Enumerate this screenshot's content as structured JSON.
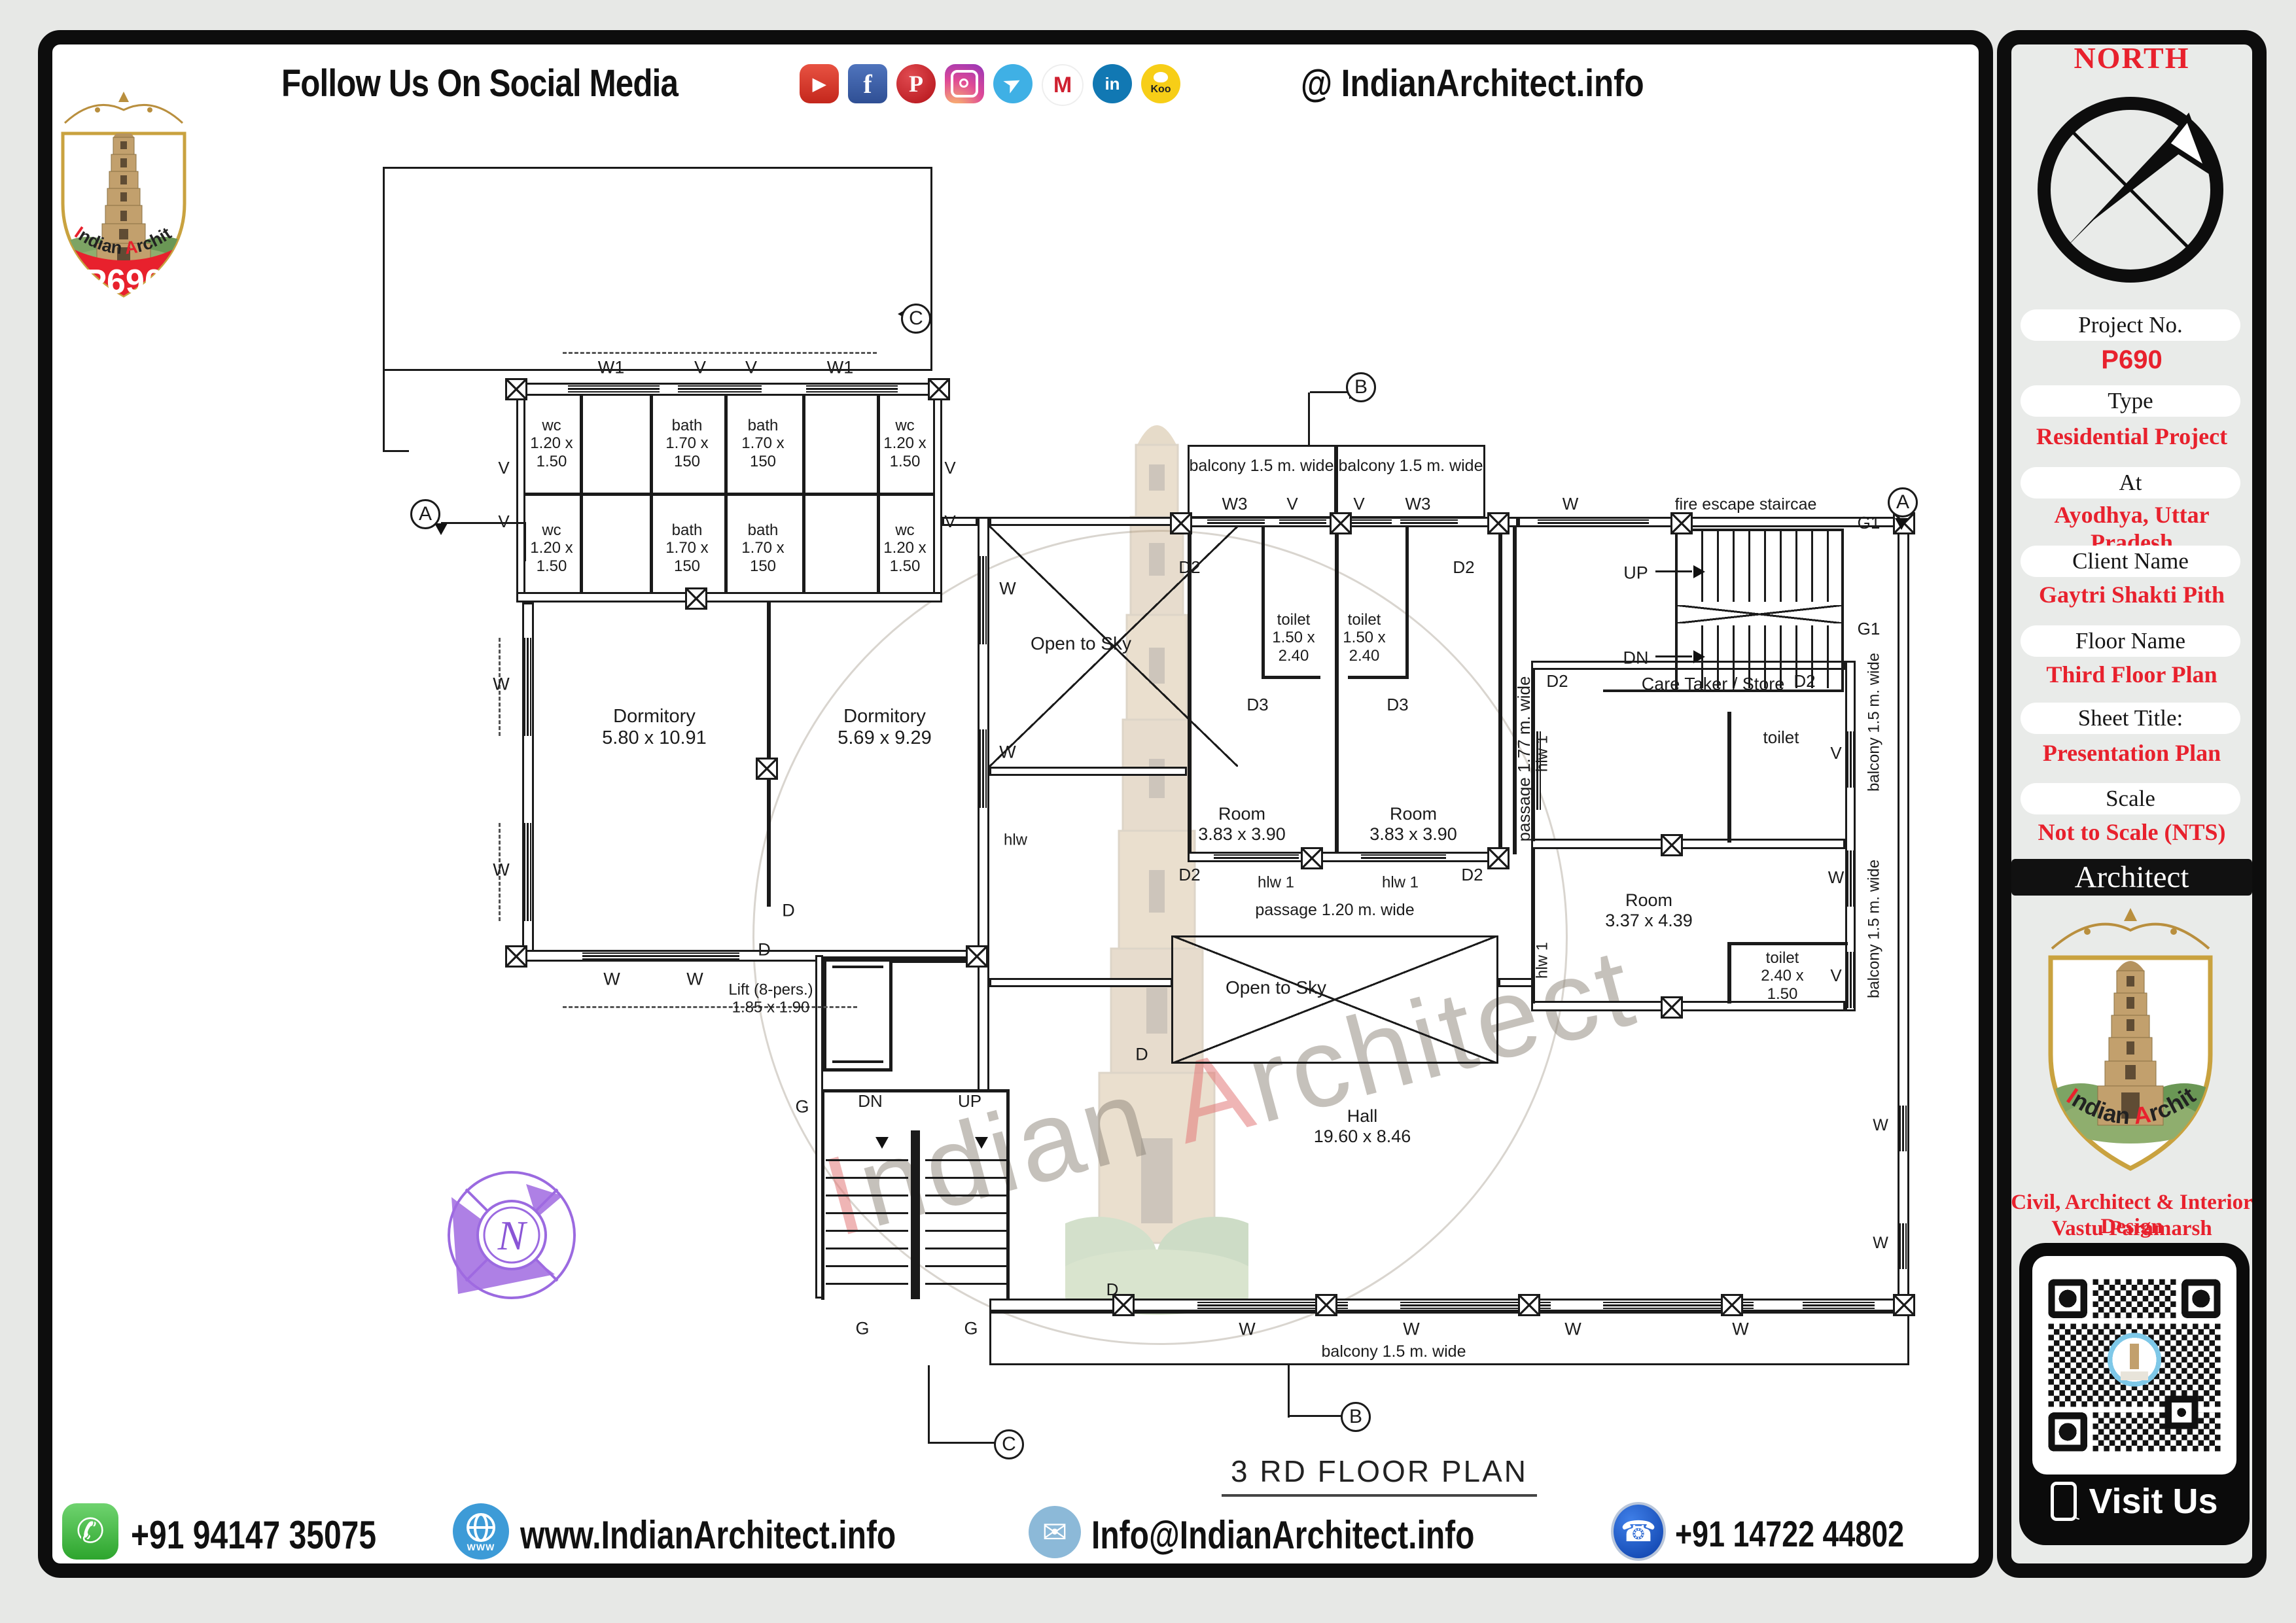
{
  "header": {
    "title": "Follow Us On Social Media",
    "handle": "@ IndianArchitect.info",
    "icons": [
      {
        "name": "youtube-icon",
        "glyph": "▶"
      },
      {
        "name": "facebook-icon",
        "glyph": "f"
      },
      {
        "name": "pinterest-icon",
        "glyph": "P"
      },
      {
        "name": "instagram-icon",
        "glyph": ""
      },
      {
        "name": "telegram-icon",
        "glyph": "➤"
      },
      {
        "name": "moj-icon",
        "glyph": "M"
      },
      {
        "name": "linkedin-icon",
        "glyph": "in"
      },
      {
        "name": "koo-icon",
        "glyph": "Koo"
      }
    ]
  },
  "brand": {
    "p1": "I",
    "p2": "ndian ",
    "p3": "A",
    "p4": "rchitect",
    "project": "P690"
  },
  "sidebar": {
    "north": "NORTH",
    "compass_n": "N",
    "fields": [
      {
        "label": "Project No.",
        "value": "P690"
      },
      {
        "label": "Type",
        "value": "Residential Project"
      },
      {
        "label": "At",
        "value": "Ayodhya, Uttar Pradesh"
      },
      {
        "label": "Client Name",
        "value": "Gaytri Shakti Pith"
      },
      {
        "label": "Floor Name",
        "value": "Third Floor Plan"
      },
      {
        "label": "Sheet Title:",
        "value": "Presentation Plan"
      },
      {
        "label": "Scale",
        "value": "Not to Scale (NTS)"
      }
    ],
    "architect_bar": "Architect",
    "tagline1": "Civil, Architect & Interior Design",
    "tagline2": "Vastu Paramarsh",
    "visit": "Visit Us"
  },
  "footer": {
    "items": [
      {
        "icon": "whatsapp-icon",
        "text": "+91 94147 35075"
      },
      {
        "icon": "globe-icon",
        "text": "www.IndianArchitect.info"
      },
      {
        "icon": "mail-icon",
        "text": "Info@IndianArchitect.info"
      },
      {
        "icon": "phone-icon",
        "text": "+91 14722 44802"
      }
    ]
  },
  "plan": {
    "title": "3 RD  FLOOR PLAN",
    "walls": [
      [
        800,
        585,
        640,
        20
      ],
      [
        789,
        585,
        14,
        336
      ],
      [
        1426,
        585,
        14,
        336
      ],
      [
        789,
        905,
        651,
        16
      ],
      [
        798,
        921,
        18,
        549
      ],
      [
        798,
        1452,
        714,
        18
      ],
      [
        1494,
        790,
        18,
        680
      ],
      [
        1512,
        790,
        303,
        14
      ],
      [
        1815,
        790,
        505,
        16
      ],
      [
        2320,
        790,
        598,
        16
      ],
      [
        2900,
        790,
        18,
        1215
      ],
      [
        1440,
        790,
        54,
        14
      ],
      [
        2340,
        1010,
        480,
        14
      ],
      [
        2340,
        1282,
        480,
        16
      ],
      [
        2340,
        1530,
        480,
        16
      ],
      [
        2820,
        1010,
        16,
        536
      ],
      [
        1815,
        1302,
        483,
        16
      ],
      [
        1512,
        1985,
        1406,
        20
      ],
      [
        1246,
        1460,
        12,
        525
      ],
      [
        1512,
        1172,
        302,
        14
      ],
      [
        1512,
        1495,
        280,
        14
      ],
      [
        2290,
        1495,
        54,
        14
      ],
      [
        1494,
        1470,
        18,
        200
      ]
    ],
    "thin": [
      [
        886,
        605,
        5,
        300
      ],
      [
        993,
        605,
        5,
        300
      ],
      [
        1107,
        605,
        5,
        300
      ],
      [
        1226,
        605,
        5,
        300
      ],
      [
        1340,
        605,
        5,
        300
      ],
      [
        803,
        753,
        623,
        5
      ],
      [
        1172,
        921,
        6,
        465
      ],
      [
        1815,
        806,
        6,
        496
      ],
      [
        2040,
        806,
        6,
        496
      ],
      [
        2290,
        806,
        6,
        496
      ],
      [
        2312,
        806,
        6,
        500
      ],
      [
        1928,
        806,
        5,
        232
      ],
      [
        2148,
        806,
        5,
        232
      ],
      [
        1928,
        1033,
        90,
        5
      ],
      [
        2060,
        1033,
        90,
        5
      ],
      [
        2640,
        1088,
        6,
        200
      ],
      [
        2340,
        1024,
        6,
        262
      ],
      [
        2340,
        1298,
        6,
        236
      ],
      [
        2640,
        1440,
        6,
        94
      ],
      [
        2640,
        1440,
        184,
        5
      ],
      [
        1255,
        1665,
        288,
        5
      ],
      [
        1255,
        1665,
        5,
        322
      ],
      [
        1538,
        1665,
        5,
        322
      ],
      [
        1392,
        1728,
        14,
        258
      ],
      [
        2560,
        808,
        258,
        4
      ],
      [
        2560,
        808,
        4,
        250
      ],
      [
        2814,
        808,
        4,
        250
      ],
      [
        2450,
        1054,
        368,
        4
      ],
      [
        1258,
        1462,
        106,
        5
      ],
      [
        1258,
        1462,
        5,
        176
      ],
      [
        1359,
        1462,
        5,
        176
      ],
      [
        1258,
        1633,
        106,
        5
      ],
      [
        1272,
        1476,
        78,
        4
      ],
      [
        1272,
        1621,
        78,
        4
      ],
      [
        1364,
        1462,
        130,
        10
      ]
    ],
    "outlines": [
      [
        1815,
        680,
        227,
        112
      ],
      [
        2042,
        680,
        228,
        112
      ],
      [
        1790,
        1430,
        500,
        196
      ],
      [
        1512,
        2005,
        1406,
        82
      ],
      [
        585,
        255,
        840,
        312
      ]
    ],
    "windows_h": [
      [
        868,
        589,
        140
      ],
      [
        1036,
        589,
        128
      ],
      [
        1232,
        589,
        140
      ],
      [
        890,
        1456,
        240
      ],
      [
        1845,
        794,
        88
      ],
      [
        1955,
        794,
        72
      ],
      [
        2055,
        794,
        72
      ],
      [
        2140,
        794,
        88
      ],
      [
        2350,
        794,
        170
      ],
      [
        1855,
        1306,
        130
      ],
      [
        2080,
        1306,
        130
      ],
      [
        1830,
        1990,
        230
      ],
      [
        2140,
        1990,
        230
      ],
      [
        2450,
        1990,
        230
      ],
      [
        2755,
        1990,
        110
      ]
    ],
    "windows_v": [
      [
        801,
        975,
        150
      ],
      [
        801,
        1258,
        150
      ],
      [
        1497,
        850,
        135
      ],
      [
        1497,
        1115,
        120
      ],
      [
        2823,
        1118,
        86
      ],
      [
        2823,
        1300,
        86
      ],
      [
        2823,
        1455,
        86
      ],
      [
        2903,
        1690,
        70
      ],
      [
        2903,
        1870,
        70
      ],
      [
        2344,
        1118,
        120
      ]
    ],
    "posts": [
      [
        772,
        578
      ],
      [
        1418,
        578
      ],
      [
        1047,
        898
      ],
      [
        772,
        1445
      ],
      [
        1476,
        1445
      ],
      [
        1155,
        1158
      ],
      [
        1788,
        783
      ],
      [
        2032,
        783
      ],
      [
        2273,
        783
      ],
      [
        2553,
        783
      ],
      [
        2893,
        783
      ],
      [
        1988,
        1295
      ],
      [
        2273,
        1295
      ],
      [
        2538,
        1275
      ],
      [
        2538,
        1523
      ],
      [
        1700,
        1978
      ],
      [
        2010,
        1978
      ],
      [
        2320,
        1978
      ],
      [
        2630,
        1978
      ],
      [
        2893,
        1978
      ]
    ],
    "crosses": [
      [
        1512,
        804,
        380,
        368
      ],
      [
        1790,
        1430,
        500,
        196
      ],
      [
        2560,
        925,
        258,
        28
      ]
    ],
    "dashes_h": [
      [
        860,
        538,
        480
      ],
      [
        860,
        1538,
        450
      ]
    ],
    "dashes_v": [
      [
        762,
        975,
        150
      ],
      [
        762,
        1258,
        150
      ]
    ],
    "lines": [
      [
        585,
        567,
        3,
        123
      ],
      [
        585,
        688,
        40,
        3
      ],
      [
        1999,
        600,
        3,
        82
      ],
      [
        2002,
        598,
        58,
        3
      ],
      [
        674,
        798,
        130,
        3
      ],
      [
        801,
        798,
        3,
        60
      ],
      [
        1968,
        2087,
        3,
        80
      ],
      [
        1968,
        2163,
        86,
        3
      ],
      [
        1418,
        2087,
        3,
        120
      ],
      [
        1418,
        2204,
        106,
        3
      ],
      [
        2530,
        872,
        56,
        3
      ],
      [
        2530,
        1002,
        56,
        3
      ]
    ],
    "stairs": [
      [
        1262,
        1772,
        126,
        212,
        "h"
      ],
      [
        1414,
        1772,
        126,
        212,
        "h"
      ],
      [
        2600,
        812,
        214,
        108,
        "v"
      ],
      [
        2600,
        956,
        214,
        96,
        "v"
      ]
    ],
    "tris": [
      [
        2062,
        590,
        "r"
      ],
      [
        2056,
        2156,
        "r"
      ],
      [
        1526,
        2197,
        "r"
      ],
      [
        1372,
        470,
        "l"
      ],
      [
        2588,
        864,
        "r"
      ],
      [
        2588,
        994,
        "r"
      ],
      [
        1338,
        1738,
        "d"
      ],
      [
        1490,
        1738,
        "d"
      ],
      [
        2896,
        792,
        "d"
      ],
      [
        664,
        800,
        "d"
      ]
    ],
    "labels": [
      [
        "W1",
        934,
        562,
        27
      ],
      [
        "V",
        1070,
        562,
        27
      ],
      [
        "V",
        1148,
        562,
        27
      ],
      [
        "W1",
        1284,
        562,
        27
      ],
      [
        "wc\n1.20 x\n1.50",
        843,
        678,
        24
      ],
      [
        "bath\n1.70 x\n150",
        1050,
        678,
        24
      ],
      [
        "bath\n1.70 x\n150",
        1166,
        678,
        24
      ],
      [
        "wc\n1.20 x\n1.50",
        1383,
        678,
        24
      ],
      [
        "wc\n1.20 x\n1.50",
        843,
        838,
        24
      ],
      [
        "bath\n1.70 x\n150",
        1050,
        838,
        24
      ],
      [
        "bath\n1.70 x\n150",
        1166,
        838,
        24
      ],
      [
        "wc\n1.20 x\n1.50",
        1383,
        838,
        24
      ],
      [
        "V",
        770,
        716,
        26
      ],
      [
        "V",
        770,
        798,
        26
      ],
      [
        "V",
        1452,
        716,
        26
      ],
      [
        "V",
        1452,
        798,
        26
      ],
      [
        "W",
        766,
        1046,
        27
      ],
      [
        "W",
        766,
        1330,
        27
      ],
      [
        "Dormitory\n5.80 x 10.91",
        1000,
        1112,
        29
      ],
      [
        "Dormitory\n5.69 x 9.29",
        1352,
        1112,
        29
      ],
      [
        "W",
        935,
        1497,
        27
      ],
      [
        "W",
        1062,
        1497,
        27
      ],
      [
        "Lift (8-pers.)\n1.85 x 1.90",
        1178,
        1527,
        24
      ],
      [
        "D",
        1205,
        1392,
        27
      ],
      [
        "D",
        1168,
        1452,
        27
      ],
      [
        "Open to Sky",
        1652,
        984,
        28
      ],
      [
        "W",
        1540,
        900,
        27
      ],
      [
        "W",
        1540,
        1150,
        27
      ],
      [
        "hlw",
        1552,
        1284,
        24
      ],
      [
        "balcony 1.5 m. wide",
        1928,
        712,
        25
      ],
      [
        "balcony 1.5 m. wide",
        2156,
        712,
        25
      ],
      [
        "W3",
        1887,
        771,
        26
      ],
      [
        "V",
        1975,
        771,
        26
      ],
      [
        "V",
        2077,
        771,
        26
      ],
      [
        "W3",
        2167,
        771,
        26
      ],
      [
        "W",
        2400,
        771,
        26
      ],
      [
        "fire escape staircae",
        2668,
        771,
        25
      ],
      [
        "D2",
        1818,
        868,
        26
      ],
      [
        "D2",
        2237,
        868,
        26
      ],
      [
        "toilet\n1.50 x\n2.40",
        1977,
        975,
        24
      ],
      [
        "toilet\n1.50 x\n2.40",
        2085,
        975,
        24
      ],
      [
        "D3",
        1922,
        1078,
        26
      ],
      [
        "D3",
        2136,
        1078,
        26
      ],
      [
        "UP",
        2500,
        876,
        27
      ],
      [
        "DN",
        2500,
        1006,
        27
      ],
      [
        "G1",
        2856,
        800,
        26
      ],
      [
        "G1",
        2856,
        962,
        26
      ],
      [
        "Room\n3.83 x 3.90",
        1898,
        1260,
        27
      ],
      [
        "Room\n3.83 x 3.90",
        2160,
        1260,
        27
      ],
      [
        "hlw 1",
        1950,
        1349,
        24
      ],
      [
        "hlw 1",
        2140,
        1349,
        24
      ],
      [
        "D2",
        1818,
        1338,
        26
      ],
      [
        "D2",
        2250,
        1338,
        26
      ],
      [
        "passage 1.20 m. wide",
        2040,
        1391,
        25
      ],
      [
        "passage 1.77 m. wide",
        2330,
        1160,
        26,
        -90
      ],
      [
        "hlw 1",
        2357,
        1152,
        24,
        -90
      ],
      [
        "hlw 1",
        2357,
        1468,
        24,
        -90
      ],
      [
        "D2",
        2380,
        1042,
        26
      ],
      [
        "D2",
        2758,
        1042,
        26
      ],
      [
        "Care Taker / Store",
        2618,
        1046,
        27
      ],
      [
        "toilet",
        2722,
        1128,
        26
      ],
      [
        "balcony 1.5 m. wide",
        2864,
        1104,
        24,
        -90
      ],
      [
        "balcony 1.5 m. wide",
        2864,
        1420,
        24,
        -90
      ],
      [
        "V",
        2806,
        1152,
        26
      ],
      [
        "W",
        2806,
        1342,
        26
      ],
      [
        "V",
        2806,
        1492,
        26
      ],
      [
        "Room\n3.37 x 4.39",
        2520,
        1392,
        27
      ],
      [
        "toilet\n2.40 x\n1.50",
        2724,
        1492,
        24
      ],
      [
        "Open to Sky",
        1950,
        1510,
        28
      ],
      [
        "D",
        1745,
        1612,
        27
      ],
      [
        "Hall\n19.60 x 8.46",
        2082,
        1722,
        27
      ],
      [
        "DN",
        1330,
        1684,
        26
      ],
      [
        "UP",
        1482,
        1684,
        26
      ],
      [
        "G",
        1226,
        1692,
        27
      ],
      [
        "W",
        2874,
        1720,
        25
      ],
      [
        "W",
        2874,
        1900,
        25
      ],
      [
        "G",
        1318,
        2031,
        27
      ],
      [
        "G",
        1484,
        2031,
        27
      ],
      [
        "W",
        1906,
        2032,
        27
      ],
      [
        "W",
        2157,
        2032,
        27
      ],
      [
        "W",
        2404,
        2032,
        27
      ],
      [
        "W",
        2660,
        2032,
        27
      ],
      [
        "balcony 1.5 m. wide",
        2130,
        2066,
        25
      ],
      [
        "D",
        1700,
        1972,
        26
      ]
    ],
    "markers": [
      [
        "A",
        650,
        786
      ],
      [
        "C",
        1400,
        487
      ],
      [
        "B",
        2080,
        592
      ],
      [
        "A",
        2908,
        768
      ],
      [
        "B",
        2072,
        2166
      ],
      [
        "C",
        1542,
        2208
      ]
    ]
  }
}
